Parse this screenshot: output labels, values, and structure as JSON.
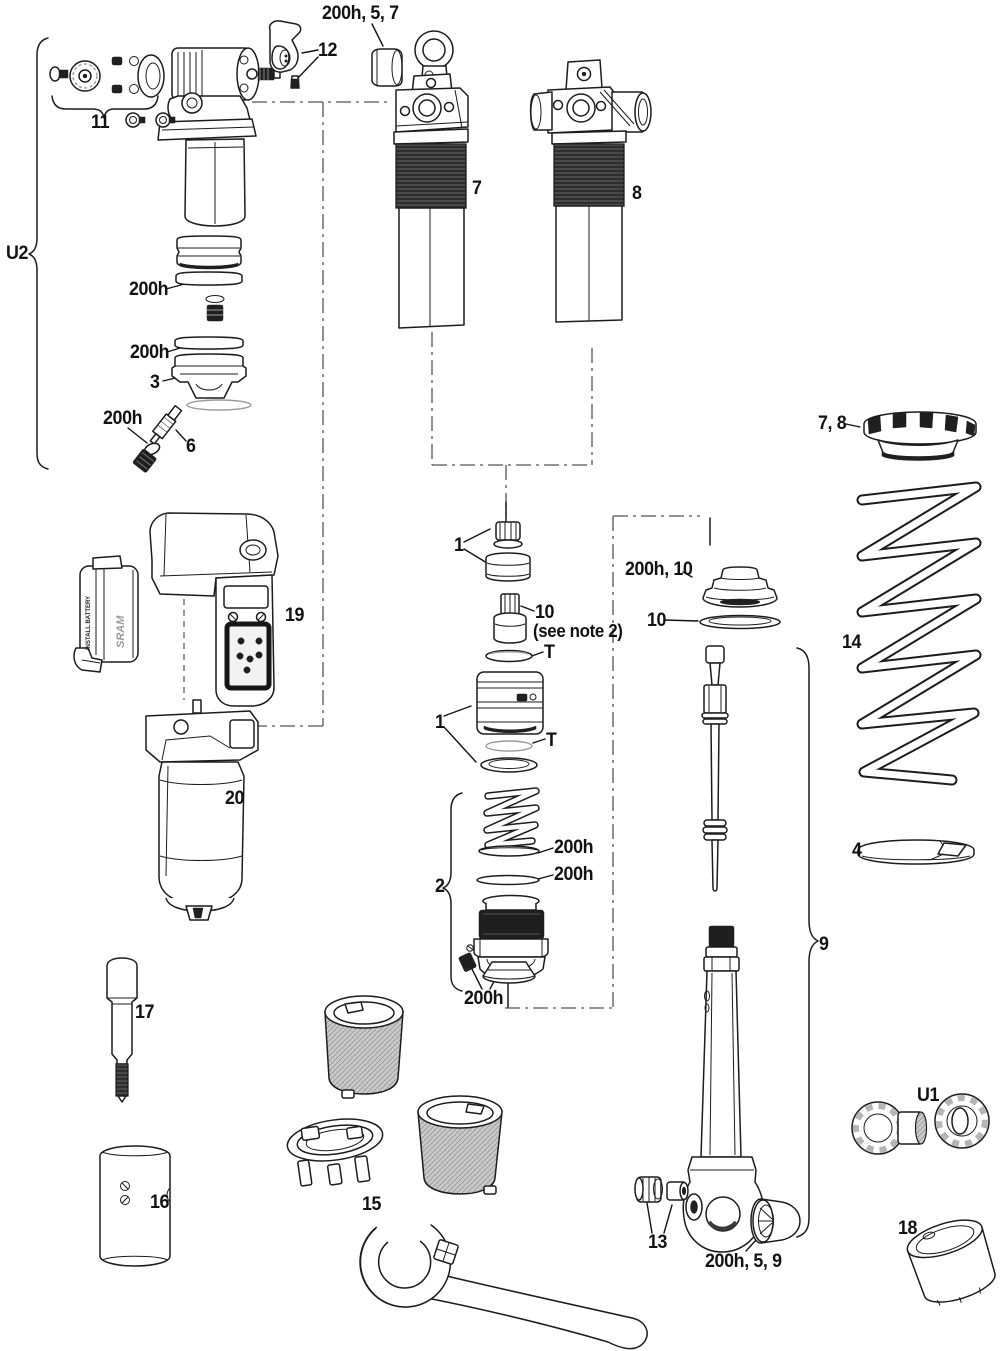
{
  "figure": {
    "type": "exploded-parts-diagram",
    "subject": "rear-shock-service-parts",
    "background": "#ffffff",
    "line_color": "#1c1c1c"
  },
  "labels": {
    "top_bushing": {
      "text": "200h, 5, 7"
    },
    "part12": {
      "text": "12"
    },
    "part11": {
      "text": "11"
    },
    "u2": {
      "text": "U2"
    },
    "seal_a": {
      "text": "200h"
    },
    "seal_b": {
      "text": "200h"
    },
    "part3": {
      "text": "3"
    },
    "seal_c": {
      "text": "200h"
    },
    "part6": {
      "text": "6"
    },
    "part7": {
      "text": "7"
    },
    "part8": {
      "text": "8"
    },
    "ring78": {
      "text": "7, 8"
    },
    "part14": {
      "text": "14"
    },
    "part4": {
      "text": "4"
    },
    "part1_top": {
      "text": "1"
    },
    "part10_top": {
      "text": "10"
    },
    "note2": {
      "text": "(see note 2)"
    },
    "t_top": {
      "text": "T"
    },
    "seal10": {
      "text": "200h, 10"
    },
    "part10_right": {
      "text": "10"
    },
    "part1_bottom": {
      "text": "1"
    },
    "t_bottom": {
      "text": "T"
    },
    "part19": {
      "text": "19"
    },
    "part20": {
      "text": "20"
    },
    "part2": {
      "text": "2"
    },
    "seal_d": {
      "text": "200h"
    },
    "seal_e": {
      "text": "200h"
    },
    "seal_f": {
      "text": "200h"
    },
    "part9": {
      "text": "9"
    },
    "part17": {
      "text": "17"
    },
    "part16": {
      "text": "16"
    },
    "part15": {
      "text": "15"
    },
    "part13": {
      "text": "13"
    },
    "bushing59": {
      "text": "200h, 5, 9"
    },
    "u1": {
      "text": "U1"
    },
    "part18": {
      "text": "18"
    }
  },
  "battery": {
    "line1": "INSTALL BATTERY",
    "brand": "SRAM"
  }
}
